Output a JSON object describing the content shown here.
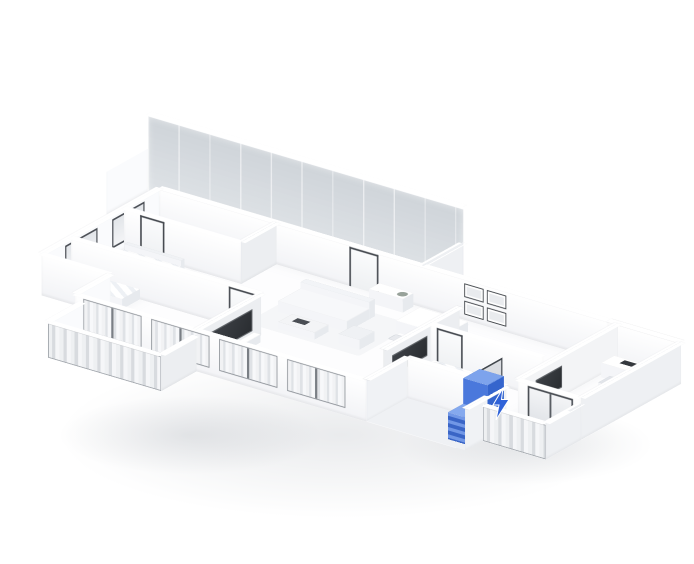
{
  "scene": {
    "description": "3D isometric cutaway floor plan of an apartment rendered as a white architectural model viewed from above; a tall entry cabinet near the entrance is highlighted in blue, with a small blue lightning-bolt marker on the wall beside it",
    "projection": "isometric",
    "render_style": "white monochrome 3D floor plan"
  },
  "colors": {
    "background": "#ffffff",
    "accent": "#3e6fd1",
    "accent_dark": "#2d54af",
    "accent_light": "#7da3ec",
    "accent_slat": "#4a78dc",
    "wall": "#ffffff",
    "wall_shade": "#eceef1",
    "glass": "#cdd3d8",
    "frame_dark": "#474b51",
    "floor": "#fdfdfe",
    "shadow": "rgba(90,100,115,0.13)"
  },
  "highlight": {
    "item": "entry-cabinet",
    "color": "#3e6fd1",
    "marker_icon": "lightning-bolt"
  },
  "icons": {
    "lightning": "lightning-bolt"
  },
  "rooms": [
    "glass-walled kitchen (rear terrace)",
    "bathroom (upper left)",
    "bedroom (left) with bed and balcony",
    "living room with sofa, coffee table and TV wall",
    "dining area with framed wall art",
    "hallway with entry door and sideboard",
    "inner bathroom with glass shower",
    "bedroom (right) with bed and TV wall",
    "home office with desk and monitor",
    "front balcony with curtained windows",
    "side balcony (right wing)",
    "entry porch with highlighted blue cabinet"
  ],
  "furniture": [
    "double bed with pillows",
    "single bed with pillows",
    "sofa with armchair",
    "coffee table with dark tray",
    "dining table with four chairs",
    "entry sideboard with plant",
    "kitchen counter with cooktop",
    "office desk with monitor and chair",
    "wall-mounted TVs",
    "2x2 framed wall pictures",
    "blue entry cabinet (highlighted)"
  ]
}
